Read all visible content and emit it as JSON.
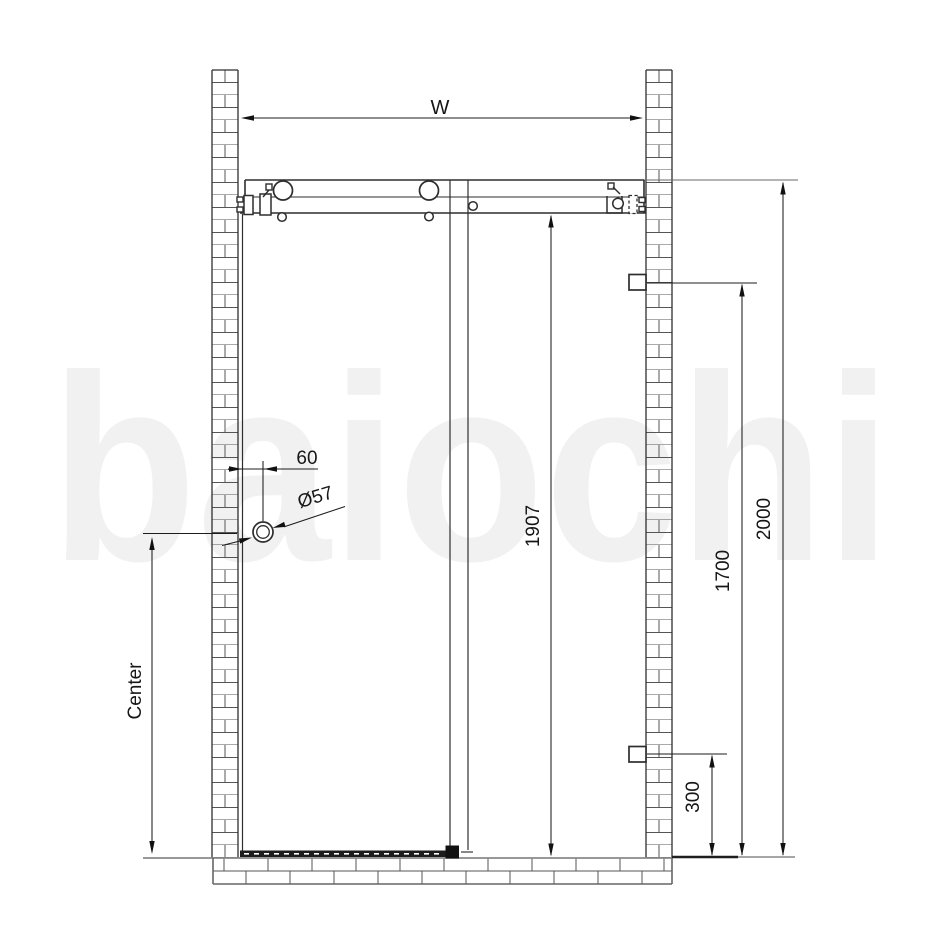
{
  "watermark": {
    "text": "baiochi"
  },
  "dimensions": {
    "opening_width": "W",
    "handle_wall_offset": "60",
    "handle_diameter": "Ø57",
    "glass_panel_height": "1907",
    "upper_bracket_height": "1700",
    "overall_height": "2000",
    "lower_bracket_height": "300",
    "handle_center_label": "Center"
  },
  "colors": {
    "background": "#ffffff",
    "drawing_line": "#2e2e2e",
    "brick_line": "#565656",
    "dimension_line": "#1c1c1c",
    "threshold_fill": "#1d1d1d",
    "watermark": "#f1f1f1"
  }
}
